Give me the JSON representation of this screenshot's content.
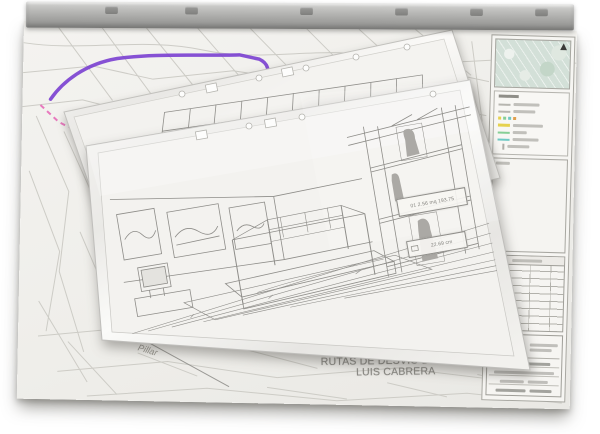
{
  "photo": {
    "subject": "Stack of construction plan sheets in plastic sleeves hanging from a metal plan-hanger rail, photographed on white",
    "background_color": "#ffffff"
  },
  "rail": {
    "color": "#a9a9a7",
    "clip_count": 6
  },
  "map_sheet": {
    "paper_color": "#f1f0ec",
    "street_line_color": "#cdccc6",
    "title": {
      "line1": "PLANO PROVISIONAL",
      "line2": "RUTAS DE DESVIO DE OBRA",
      "line3": "LUIS CABRERA",
      "text_color": "#8a8984"
    },
    "routes": {
      "detour_primary_color": "#7a3fd0",
      "detour_secondary_color": "#e565b5",
      "highlight_yellow": "#e6d24e"
    },
    "handwritten_note": "Pillar"
  },
  "side_panel": {
    "inset_map": {
      "fill_color": "#d3e0d8",
      "marker_color": "#3a3a38"
    },
    "legend_swatch_colors": [
      "#b7b6b0",
      "#b7b6b0",
      "#e6d24e",
      "#86cf96",
      "#6fc9c4",
      "#e0a04e"
    ],
    "revision_table_rows": 9,
    "title_block_logo_colors": [
      "#a7c93f",
      "#e8c83e"
    ]
  },
  "middle_sheet": {
    "subject": "Pencil perspective sketch of a gridded frame structure in a punched plastic sleeve"
  },
  "front_sheet": {
    "subject": "Pencil perspective sketch of a museum bedroom interior (four-poster bed, TV cabinet, framed pictures, statue niches)",
    "annotations": {
      "area_label": "01 2.56 mq 193.75",
      "size_label": "22.69 cm"
    }
  }
}
